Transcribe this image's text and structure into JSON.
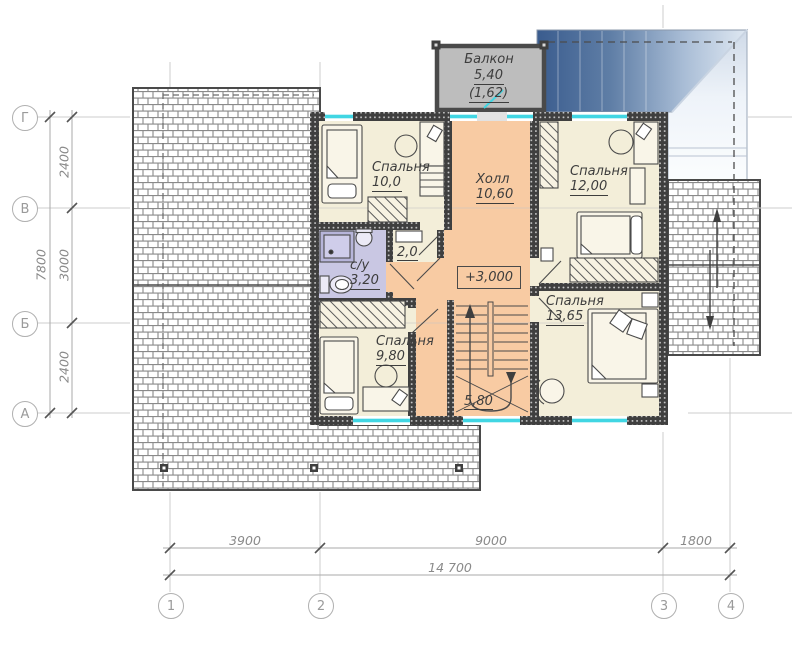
{
  "labels": {
    "balcony": {
      "name": "Балкон",
      "area": "5,40",
      "sub": "(1,62)"
    },
    "bedroom_tl": {
      "name": "Спальня",
      "area": "10,0"
    },
    "bedroom_tr": {
      "name": "Спальня",
      "area": "12,00"
    },
    "bedroom_bl": {
      "name": "Спальня",
      "area": "9,80"
    },
    "bedroom_br": {
      "name": "Спальня",
      "area": "13,65"
    },
    "hall": {
      "name": "Холл",
      "area": "10,60"
    },
    "bathroom": {
      "name": "с/у",
      "area": "3,20"
    },
    "closet": {
      "area": "2,0"
    },
    "stairs": {
      "area": "5,80"
    },
    "elevation": "+3,000"
  },
  "axes": {
    "rows": [
      "Г",
      "В",
      "Б",
      "А"
    ],
    "cols": [
      "1",
      "2",
      "3",
      "4"
    ]
  },
  "dimensions": {
    "vertical": {
      "segments": [
        "2400",
        "3000",
        "2400"
      ],
      "total": "7800"
    },
    "horizontal": {
      "segments": [
        "3900",
        "9000",
        "1800"
      ],
      "total": "14 700"
    }
  },
  "colors": {
    "hall": "#f8cba3",
    "room": "#f3eed9",
    "bath": "#c9c7e3",
    "balcony": "#bdbdbd",
    "window": "#41d6e3",
    "wall": "#3f3f3f",
    "roofdark": "#3a5c8e",
    "rooflight": "#eef3f9",
    "hatch": "#8a8a8a"
  }
}
